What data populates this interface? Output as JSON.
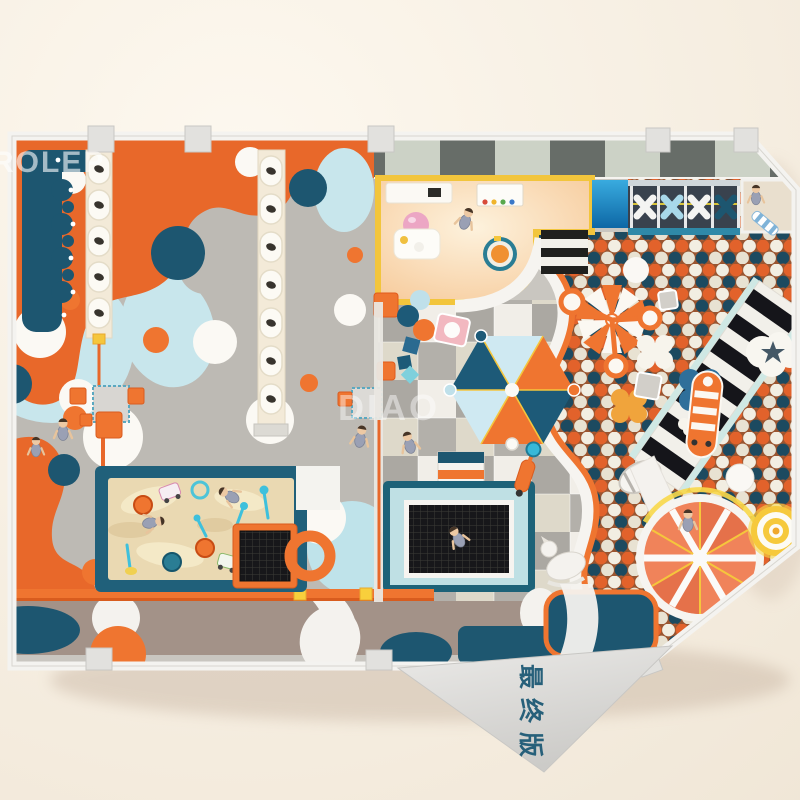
{
  "watermarks": {
    "brand_top_left": "ROLEP",
    "brand_center": "DIAO",
    "version_label": "最终版"
  },
  "palette": {
    "orange": "#EF7530",
    "deep_orange": "#E2622B",
    "dark_teal": "#1D5670",
    "light_blue": "#C8E6EC",
    "cream": "#F6EEDC",
    "sand": "#EAD9B2",
    "yellow": "#F5C63C",
    "floor_gray": "#BDBAB4",
    "wall_dark": "#676D68",
    "wall_light": "#CCD2C6",
    "background": "#F7F0E4",
    "ball_navy": "#1C4A60",
    "ball_white": "#F2EEE2"
  }
}
